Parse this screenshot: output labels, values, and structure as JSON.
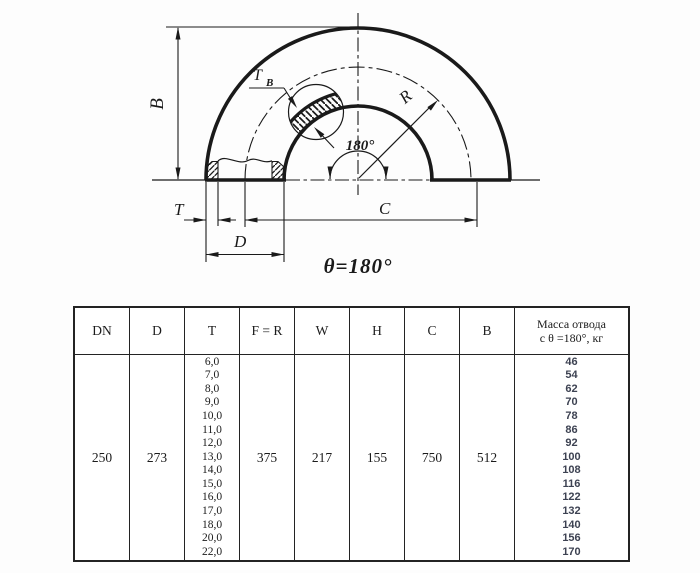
{
  "drawing": {
    "labels": {
      "b": "B",
      "t": "T",
      "d": "D",
      "c": "C",
      "r": "R",
      "tb_main": "T",
      "tb_sub": "B",
      "angle": "180°",
      "theta": "θ=180°"
    }
  },
  "table": {
    "headers": [
      "DN",
      "D",
      "T",
      "F = R",
      "W",
      "H",
      "C",
      "B"
    ],
    "mass_header": {
      "line1": "Масса отвода",
      "line2": "с θ =180°, кг"
    },
    "row": {
      "dn": "250",
      "d": "273",
      "f_r": "375",
      "w": "217",
      "h": "155",
      "c": "750",
      "b": "512"
    },
    "t_values": [
      "6,0",
      "7,0",
      "8,0",
      "9,0",
      "10,0",
      "11,0",
      "12,0",
      "13,0",
      "14,0",
      "15,0",
      "16,0",
      "17,0",
      "18,0",
      "20,0",
      "22,0"
    ],
    "mass_values": [
      "46",
      "54",
      "62",
      "70",
      "78",
      "86",
      "92",
      "100",
      "108",
      "116",
      "122",
      "132",
      "140",
      "156",
      "170"
    ]
  }
}
